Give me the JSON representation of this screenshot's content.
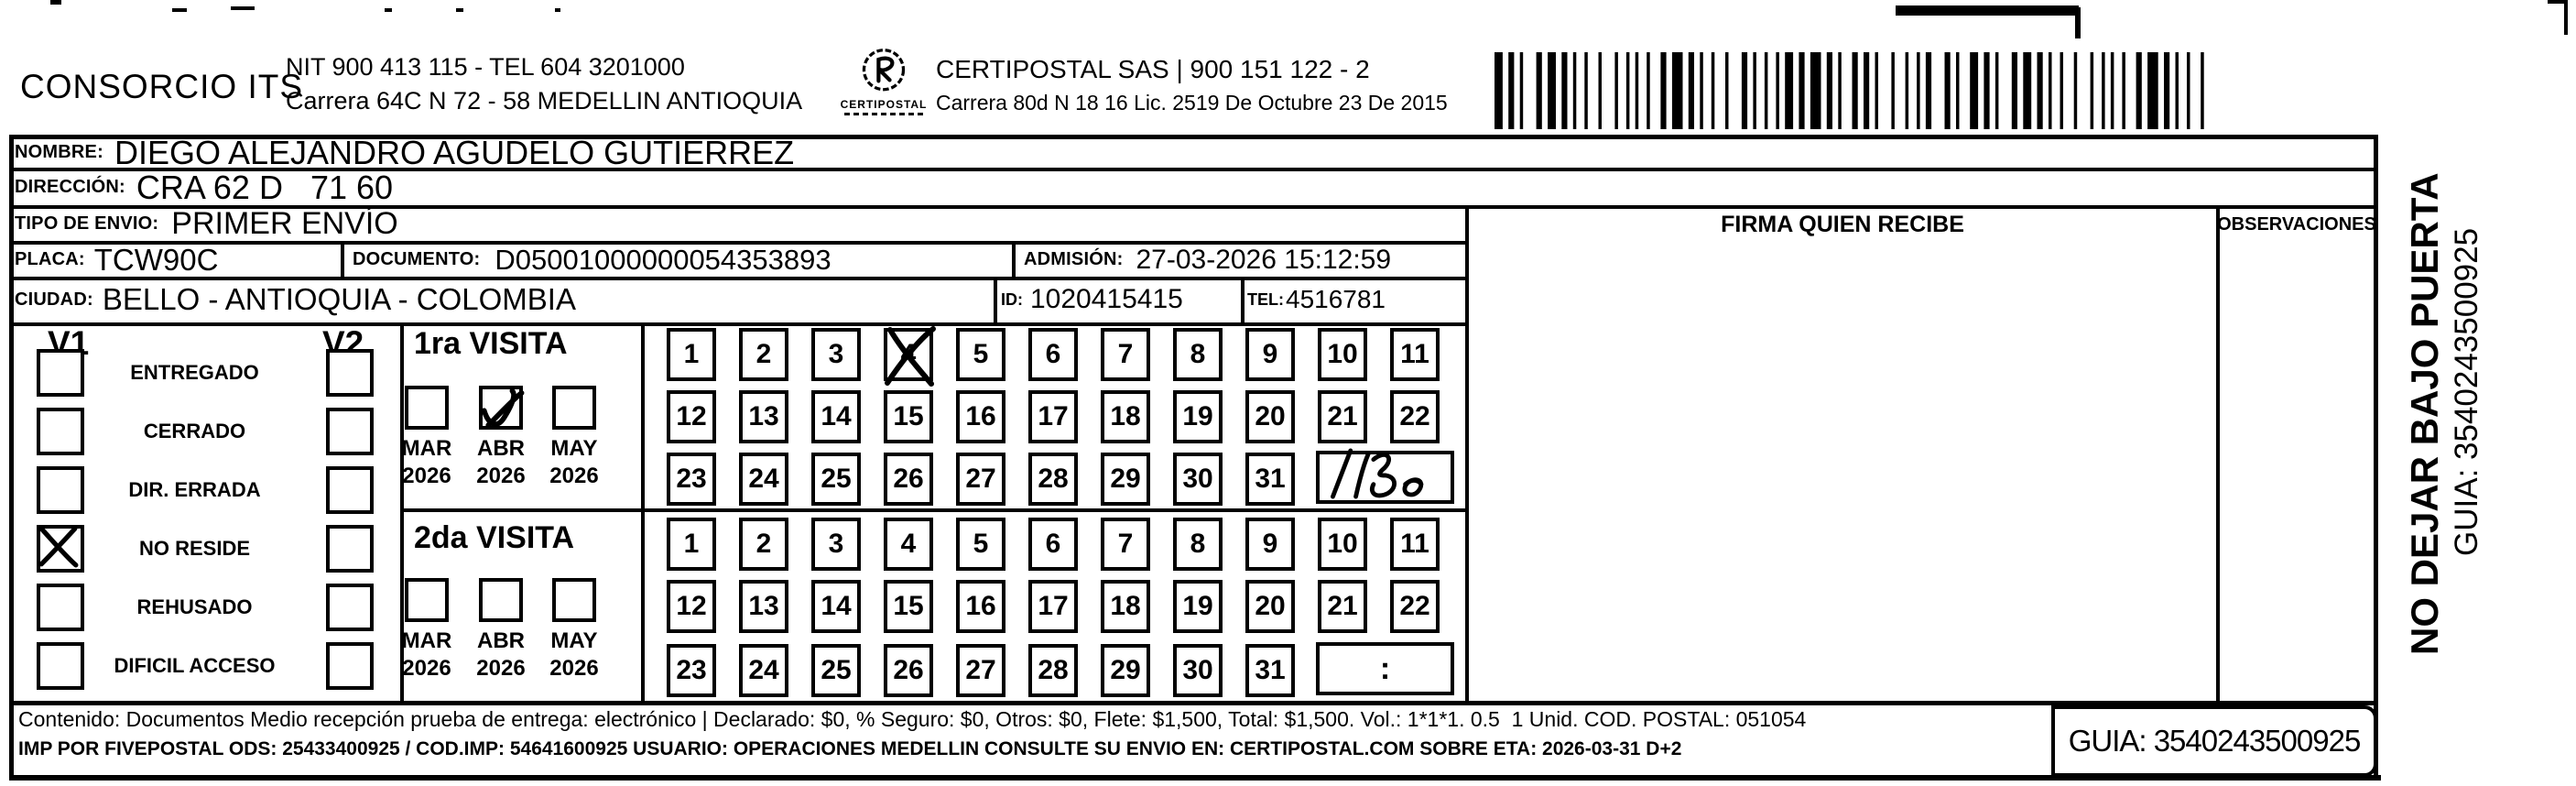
{
  "header": {
    "company_name": "CONSORCIO ITS",
    "nit_tel": "NIT 900 413 115 - TEL 604 3201000",
    "address": "Carrera 64C N 72 - 58 MEDELLIN ANTIOQUIA",
    "logo_name": "CERTIPOSTAL",
    "partner_line": "CERTIPOSTAL SAS | 900 151 122 - 2",
    "partner_address": "Carrera 80d N 18 16  Lic. 2519 De Octubre 23 De 2015"
  },
  "shipment": {
    "nombre": {
      "label": "NOMBRE:",
      "value": "DIEGO ALEJANDRO AGUDELO GUTIERREZ"
    },
    "direccion": {
      "label": "DIRECCIÓN:",
      "value": "CRA 62 D   71 60"
    },
    "tipo_envio": {
      "label": "TIPO DE ENVIO:",
      "value": "PRIMER ENVÍO"
    },
    "placa": {
      "label": "PLACA:",
      "value": "TCW90C"
    },
    "documento": {
      "label": "DOCUMENTO:",
      "value": "D05001000000054353893"
    },
    "admision": {
      "label": "ADMISIÓN:",
      "value": "27-03-2026 15:12:59"
    },
    "ciudad": {
      "label": "CIUDAD:",
      "value": "BELLO - ANTIOQUIA - COLOMBIA"
    },
    "id": {
      "label": "ID:",
      "value": "1020415415"
    },
    "tel": {
      "label": "TEL:",
      "value": "4516781"
    }
  },
  "table_headers": {
    "firma": "FIRMA QUIEN RECIBE",
    "observaciones": "OBSERVACIONES"
  },
  "delivery_status": {
    "col1": "V1",
    "col2": "V2",
    "options": [
      {
        "label": "ENTREGADO",
        "v1_checked": false,
        "v2_checked": false
      },
      {
        "label": "CERRADO",
        "v1_checked": false,
        "v2_checked": false
      },
      {
        "label": "DIR. ERRADA",
        "v1_checked": false,
        "v2_checked": false
      },
      {
        "label": "NO RESIDE",
        "v1_checked": true,
        "v2_checked": false
      },
      {
        "label": "REHUSADO",
        "v1_checked": false,
        "v2_checked": false
      },
      {
        "label": "DIFICIL ACCESO",
        "v1_checked": false,
        "v2_checked": false
      }
    ]
  },
  "visits": {
    "days": [
      1,
      2,
      3,
      4,
      5,
      6,
      7,
      8,
      9,
      10,
      11,
      12,
      13,
      14,
      15,
      16,
      17,
      18,
      19,
      20,
      21,
      22,
      23,
      24,
      25,
      26,
      27,
      28,
      29,
      30,
      31
    ],
    "first": {
      "title": "1ra VISITA",
      "months": [
        {
          "month": "MAR",
          "year": "2026",
          "checked": false
        },
        {
          "month": "ABR",
          "year": "2026",
          "checked": true
        },
        {
          "month": "MAY",
          "year": "2026",
          "checked": false
        }
      ],
      "crossed_day": 4,
      "handwritten_note": "1130"
    },
    "second": {
      "title": "2da VISITA",
      "months": [
        {
          "month": "MAR",
          "year": "2026",
          "checked": false
        },
        {
          "month": "ABR",
          "year": "2026",
          "checked": false
        },
        {
          "month": "MAY",
          "year": "2026",
          "checked": false
        }
      ],
      "time_placeholder": ":"
    }
  },
  "footer": {
    "content_line": "Contenido: Documentos Medio recepción prueba de entrega: electrónico | Declarado: $0, % Seguro: $0, Otros: $0, Flete: $1,500, Total: $1,500. Vol.: 1*1*1. 0.5  1 Unid. COD. POSTAL: 051054",
    "imp_line": "IMP POR FIVEPOSTAL ODS: 25433400925 / COD.IMP: 54641600925 USUARIO: OPERACIONES MEDELLIN CONSULTE SU ENVIO EN: CERTIPOSTAL.COM SOBRE ETA: 2026-03-31 D+2",
    "guia": "GUIA: 3540243500925"
  },
  "side_note": {
    "warning": "NO DEJAR BAJO PUERTA",
    "guia": "GUIA: 3540243500925"
  }
}
